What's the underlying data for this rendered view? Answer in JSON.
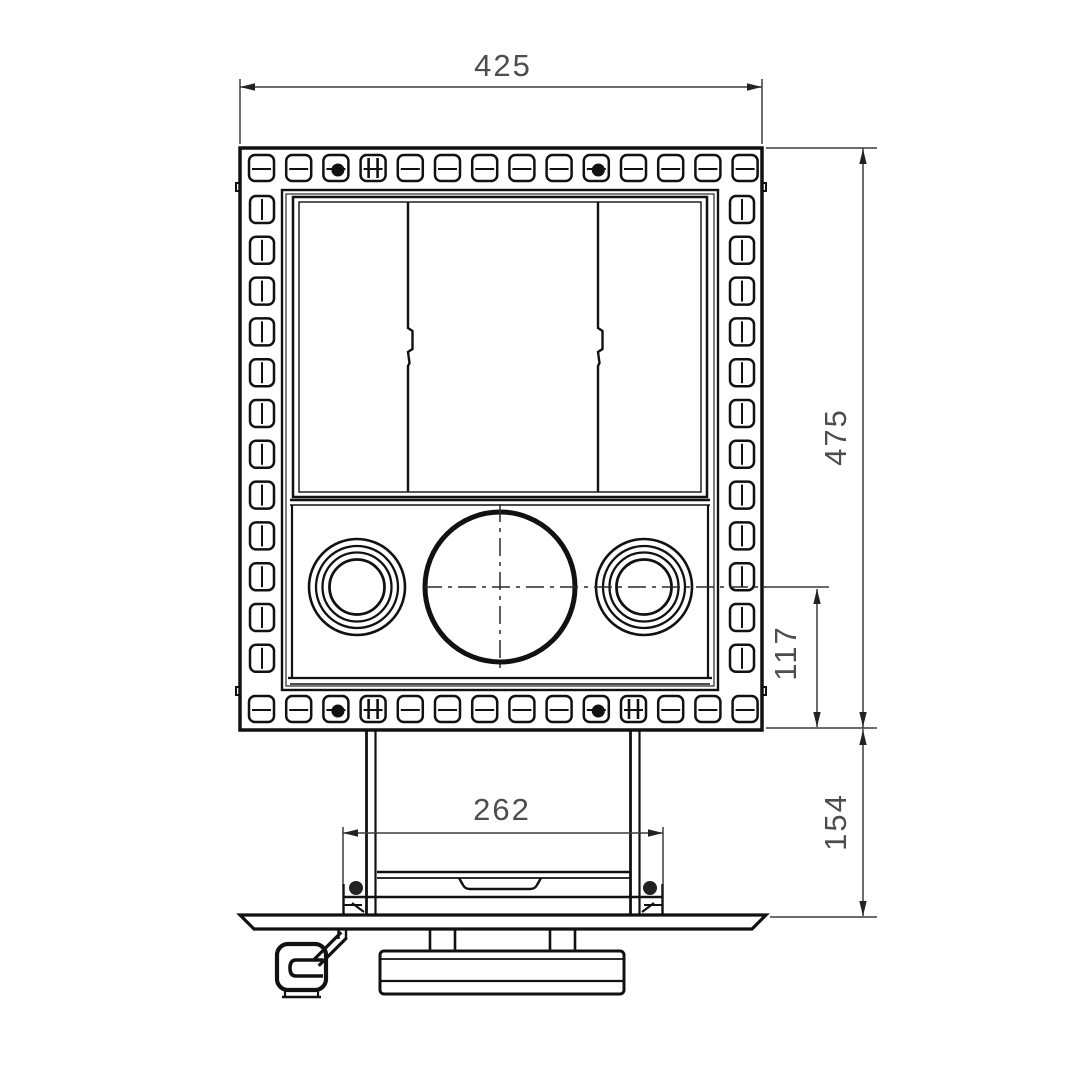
{
  "drawing": {
    "type": "technical-drawing",
    "view": "front-elevation",
    "subject": "wood stove front view with perforated frame, three-pane glass door, twin round air controls, flue circle, legs and pedestal base",
    "units": "mm",
    "background_color": "#ffffff",
    "line_color": "#111111",
    "dimension_color": "#4d4d4d",
    "dimensions": {
      "overall_width": {
        "label": "425",
        "orientation": "horizontal",
        "position": "top"
      },
      "overall_height": {
        "label": "475",
        "orientation": "vertical",
        "position": "right-outer"
      },
      "circle_axis_to_bottom": {
        "label": "117",
        "orientation": "vertical",
        "position": "right-inner"
      },
      "plinth_height": {
        "label": "154",
        "orientation": "vertical",
        "position": "bottom-right"
      },
      "leg_spacing": {
        "label": "262",
        "orientation": "horizontal",
        "position": "bottom-center"
      }
    },
    "frame_holes": {
      "top_count": 14,
      "bottom_count": 14,
      "left_count": 12,
      "right_count": 12,
      "top_blob_indices": [
        2,
        9
      ],
      "top_bar_indices": [
        3
      ],
      "bottom_blob_indices": [
        2,
        9
      ],
      "bottom_bar_indices": [
        3,
        10
      ]
    },
    "window": {
      "pane_count": 3
    },
    "controls": {
      "left_knob_rings": 4,
      "right_knob_rings": 4,
      "center_circle": 1
    }
  }
}
